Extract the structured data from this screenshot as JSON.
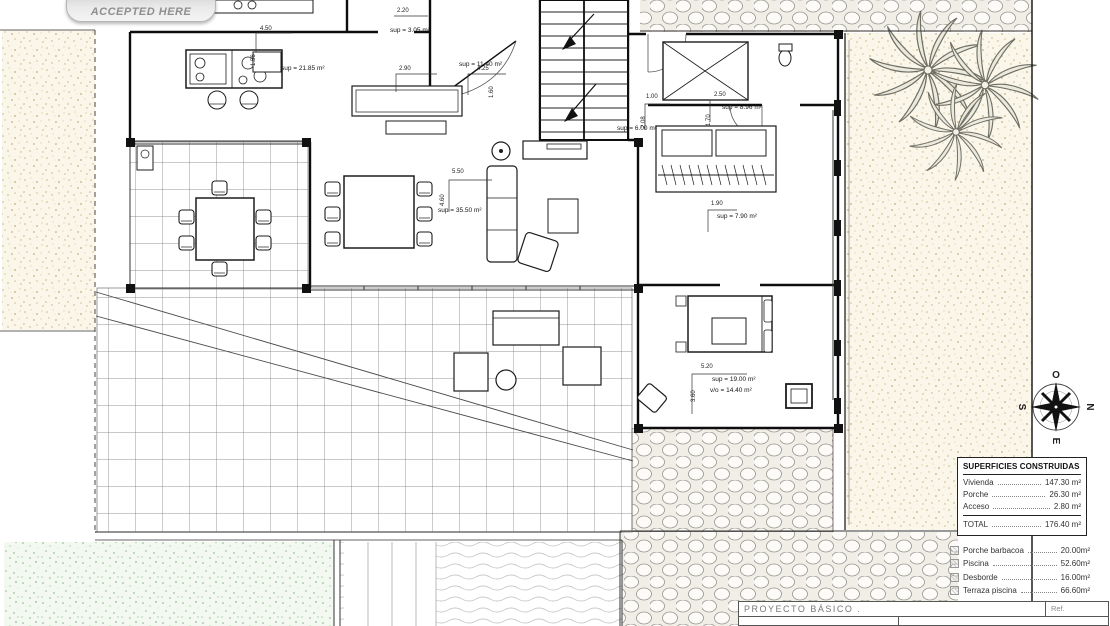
{
  "badge": {
    "label": "ACCEPTED HERE"
  },
  "compass": {
    "west": "O",
    "north": "N",
    "east": "E",
    "south": "S"
  },
  "surfaces_table": {
    "title": "SUPERFICIES CONSTRUIDAS",
    "rows": [
      {
        "label": "Vivienda",
        "value": "147.30 m²"
      },
      {
        "label": "Porche",
        "value": "26.30 m²"
      },
      {
        "label": "Acceso",
        "value": "2.80 m²"
      }
    ],
    "total_label": "TOTAL",
    "total_value": "176.40 m²"
  },
  "exterior_areas": [
    {
      "label": "Porche barbacoa",
      "value": "20.00m²"
    },
    {
      "label": "Piscina",
      "value": "52.60m²"
    },
    {
      "label": "Desborde",
      "value": "16.00m²"
    },
    {
      "label": "Terraza piscina",
      "value": "66.60m²"
    }
  ],
  "title_block": {
    "project": "PROYECTO BÁSICO .",
    "ref": "Ref."
  },
  "area_labels": [
    {
      "text": "sup = 21.85 m²",
      "x": 281,
      "y": 66
    },
    {
      "text": "sup = 3.05 m²",
      "x": 390,
      "y": 28
    },
    {
      "text": "sup = 11.40 m²",
      "x": 459,
      "y": 62
    },
    {
      "text": "sup = 6.00 m²",
      "x": 617,
      "y": 126
    },
    {
      "text": "sup = 8.96 m²",
      "x": 722,
      "y": 105
    },
    {
      "text": "sup = 35.50 m²",
      "x": 438,
      "y": 208
    },
    {
      "text": "sup = 7.90 m²",
      "x": 717,
      "y": 214
    },
    {
      "text": "sup = 19.00 m²",
      "x": 712,
      "y": 377
    },
    {
      "text": "v/o = 14.40 m²",
      "x": 710,
      "y": 388
    }
  ],
  "dimension_labels": [
    {
      "text": "4.50",
      "x": 260,
      "y": 26,
      "rot": 0
    },
    {
      "text": "1.56",
      "x": 251,
      "y": 66,
      "rot": -90
    },
    {
      "text": "2.20",
      "x": 397,
      "y": 8,
      "rot": 0
    },
    {
      "text": "2.90",
      "x": 399,
      "y": 66,
      "rot": 0
    },
    {
      "text": "4.25",
      "x": 477,
      "y": 66,
      "rot": 0
    },
    {
      "text": "1.60",
      "x": 489,
      "y": 98,
      "rot": -90
    },
    {
      "text": "1.00",
      "x": 646,
      "y": 94,
      "rot": 0
    },
    {
      "text": "2.08",
      "x": 641,
      "y": 128,
      "rot": -90
    },
    {
      "text": "2.50",
      "x": 714,
      "y": 92,
      "rot": 0
    },
    {
      "text": "1.70",
      "x": 706,
      "y": 126,
      "rot": -90
    },
    {
      "text": "1.90",
      "x": 711,
      "y": 201,
      "rot": 0
    },
    {
      "text": "5.50",
      "x": 452,
      "y": 169,
      "rot": 0
    },
    {
      "text": "4.60",
      "x": 440,
      "y": 206,
      "rot": -90
    },
    {
      "text": "5.20",
      "x": 701,
      "y": 364,
      "rot": 0
    },
    {
      "text": "3.60",
      "x": 691,
      "y": 402,
      "rot": -90
    }
  ]
}
